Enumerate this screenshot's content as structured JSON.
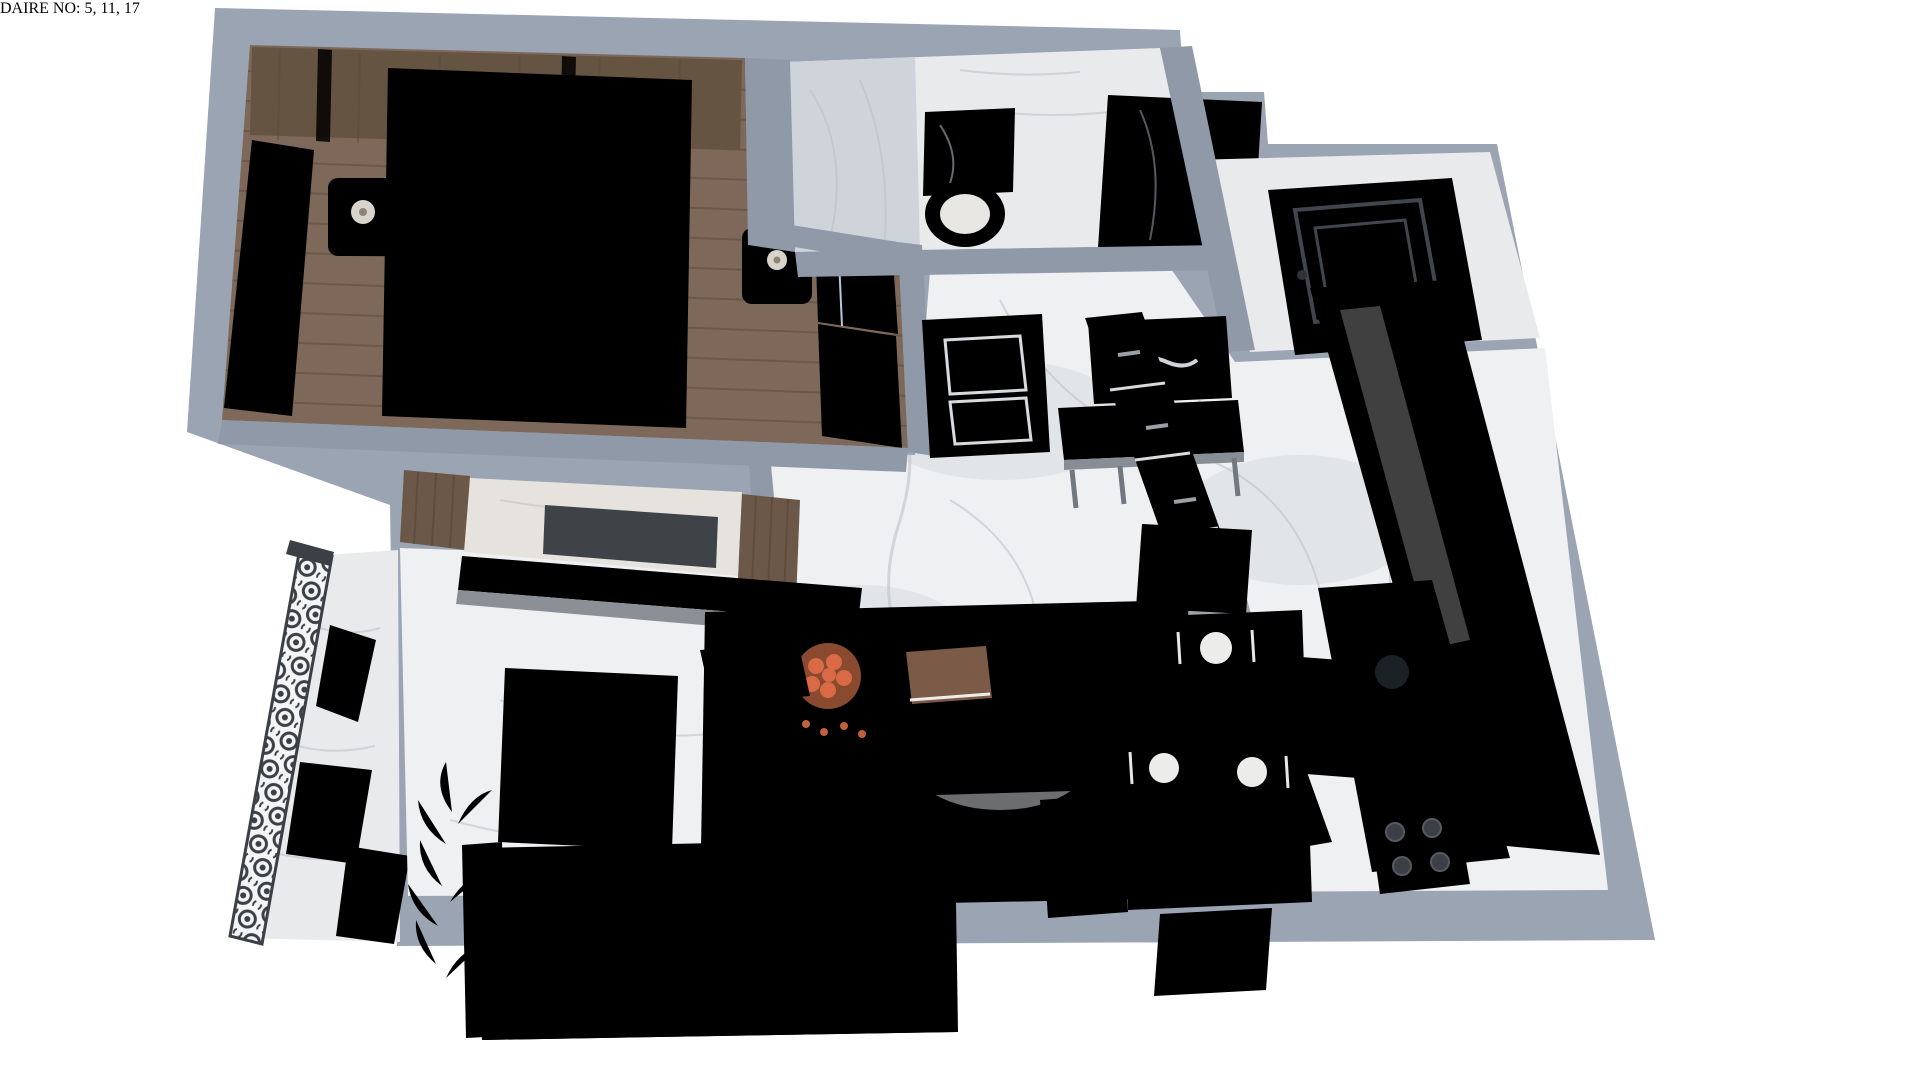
{
  "caption": {
    "text": "DAIRE NO: 5, 11, 17"
  },
  "palette": {
    "page_bg": "#ffffff",
    "caption_ink": "#141414",
    "wall": "#9aa4b2",
    "wall_band": "#8f99a7",
    "wall_edge": "#57616d",
    "floor_marble": "#eef0f2",
    "floor_light": "#e8eaec",
    "vein": "#b9bfc7",
    "blotch": "#d6dade",
    "wood_floor": "#7d685a",
    "wood_line": "#63513f",
    "wood_panel": "#665443",
    "gold": "#c9ad72",
    "curtain": "#edeff1",
    "curtain_line": "#d5dade",
    "bed_white": "#f3f2f0",
    "bed_gray": "#918d86",
    "pillow": "#f8f8f7",
    "pillow_edge": "#dcdcda",
    "nightstand": "#6f5a46",
    "lamp": "#f0eee9",
    "wardrobe": "#cdddeb",
    "marble_dark": "#23272e",
    "chrome": "#c8cdd2",
    "basin": "#f2f2f1",
    "door_dark": "#51565e",
    "door_white": "#f5f6f7",
    "mirror_glass": "#454b52",
    "mirror_frame": "#b99c5e",
    "console": "#9aa1a8",
    "cabinet": "#eef0f1",
    "fridge": "#c3d4e8",
    "counter": "#f0f1f2",
    "sink": "#2b3036",
    "stove": "#26292e",
    "sofa": "#a7a29b",
    "sofa_dark": "#99948d",
    "sofa_light": "#b0aba4",
    "seam": "#8e897f",
    "rug": "#d7d4ce",
    "rug_red": "#bf5a36",
    "coffee_table": "#686d73",
    "dining_table": "#563f2f",
    "table_grain": "#493526",
    "chair": "#d4cdc0",
    "chair_seat": "#c4bcab",
    "plant": "#38702f",
    "plant_dark": "#274f22",
    "silver": "#c7ccd1",
    "balcony_wood": "#b59a77",
    "balcony_mat": "#8d99a8"
  },
  "scene": {
    "type": "3d-top-down-floor-plan-render",
    "rooms": [
      "bedroom",
      "bathroom",
      "entry-vestibule",
      "hall",
      "kitchen",
      "living-dining-room",
      "balcony"
    ],
    "furniture": [
      "double-bed",
      "nightstands-with-lamps",
      "wardrobe",
      "curtains",
      "vanity-sink",
      "shower",
      "entrance-door",
      "interior-white-door",
      "console-table",
      "wall-mirror",
      "tv-unit",
      "sofa",
      "coffee-table",
      "area-rug",
      "dining-table-with-chairs",
      "kitchen-cabinets",
      "fridge",
      "round-sink",
      "cooktop",
      "balcony-railing",
      "lounge-chairs",
      "potted-plant"
    ]
  }
}
